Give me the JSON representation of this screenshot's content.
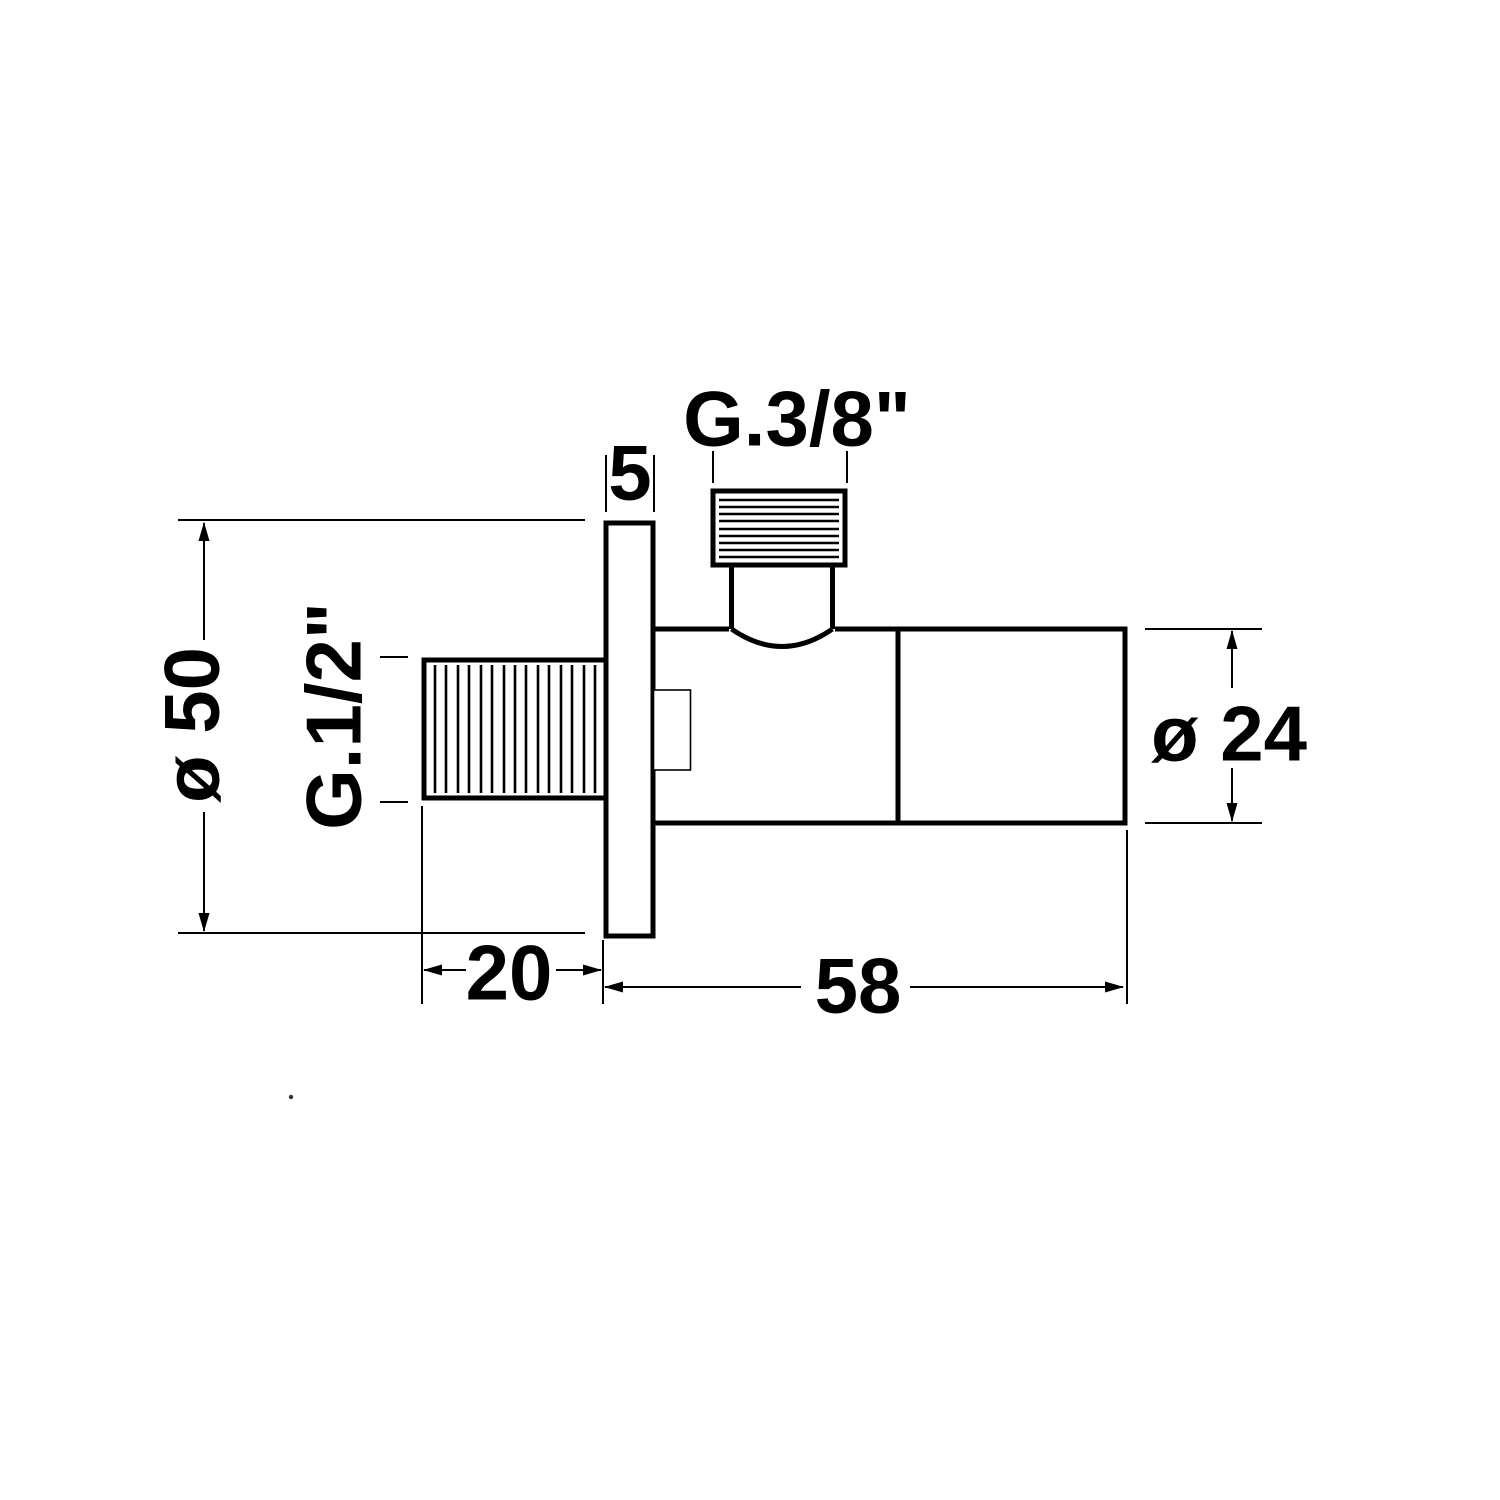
{
  "drawing": {
    "subject": "angle-valve-side-view"
  },
  "colors": {
    "line": "#000000",
    "background": "#ffffff"
  },
  "labels": {
    "outlet_thread": "G.3/8\"",
    "flange_thickness": "5",
    "inlet_thread": "G.1/2\"",
    "flange_diameter": "ø 50",
    "handle_diameter": "ø 24",
    "inlet_length": "20",
    "body_length": "58"
  }
}
